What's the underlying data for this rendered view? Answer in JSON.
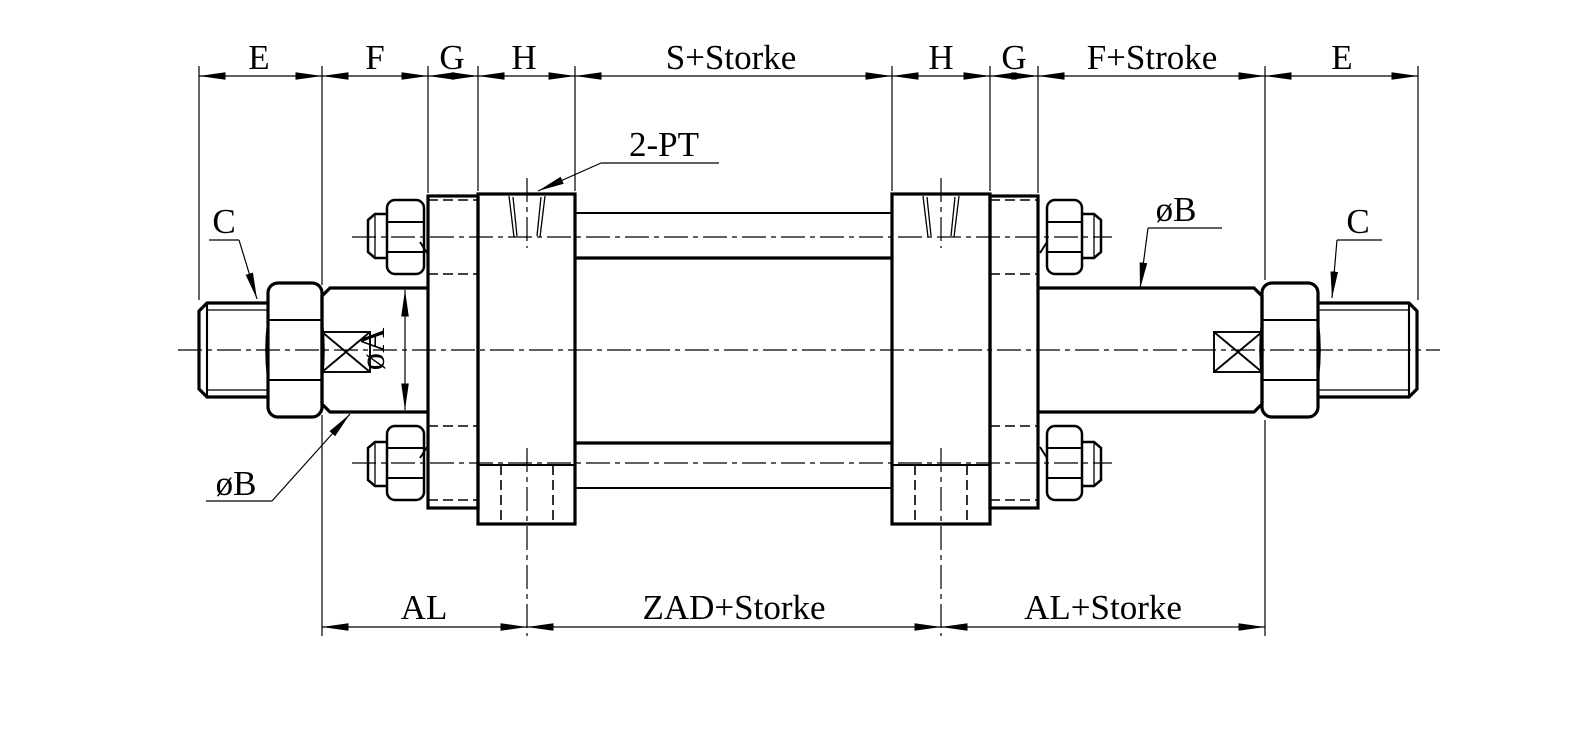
{
  "drawing": {
    "type": "engineering-drawing",
    "subject": "double-rod tie-rod hydraulic cylinder, side section view",
    "colors": {
      "background": "#ffffff",
      "line": "#000000"
    },
    "top_dims": [
      {
        "label": "E"
      },
      {
        "label": "F"
      },
      {
        "label": "G"
      },
      {
        "label": "H"
      },
      {
        "label": "S+Storke"
      },
      {
        "label": "H"
      },
      {
        "label": "G"
      },
      {
        "label": "F+Stroke"
      },
      {
        "label": "E"
      }
    ],
    "bottom_dims": [
      {
        "label": "AL"
      },
      {
        "label": "ZAD+Storke"
      },
      {
        "label": "AL+Storke"
      }
    ],
    "callouts": {
      "port_label": "2-PT",
      "thread_left": "C",
      "thread_right": "C",
      "rod_dia": "øA",
      "rod_od_left": "øB",
      "rod_od_right": "øB"
    }
  }
}
